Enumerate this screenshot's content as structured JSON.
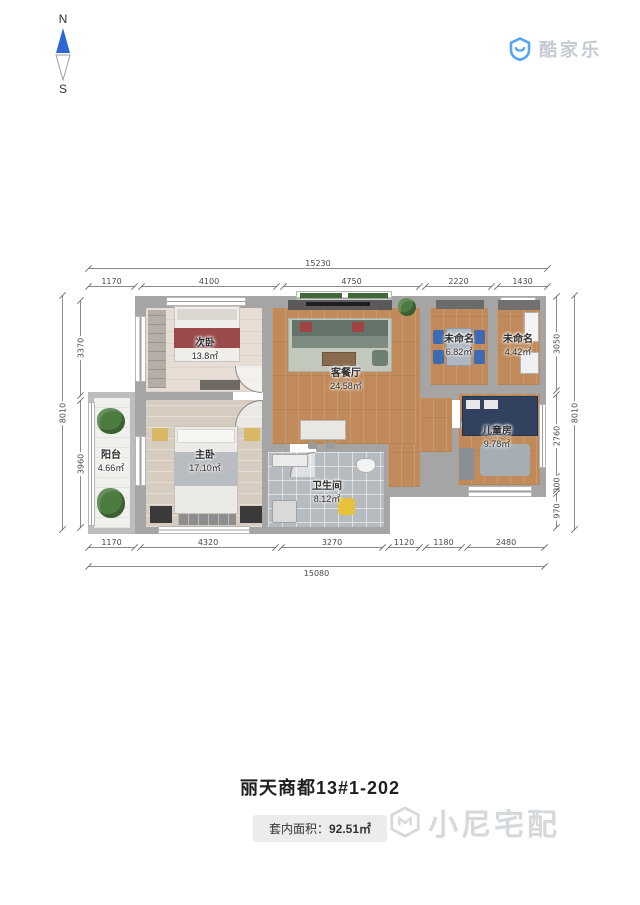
{
  "compass": {
    "north_label": "N",
    "south_label": "S"
  },
  "header": {
    "brand": "酷家乐"
  },
  "colors": {
    "brand_blue": "#57a4f5",
    "compass_blue": "#2e67d3",
    "wall_gray": "#a5a5a5",
    "wood_floor": "#c08a5a"
  },
  "floorplan": {
    "rooms": [
      {
        "name": "次卧",
        "area": "13.8㎡"
      },
      {
        "name": "客餐厅",
        "area": "24.58㎡"
      },
      {
        "name": "未命名",
        "area": "6.82㎡"
      },
      {
        "name": "未命名",
        "area": "4.42㎡"
      },
      {
        "name": "儿童房",
        "area": "9.78㎡"
      },
      {
        "name": "主卧",
        "area": "17.10㎡"
      },
      {
        "name": "卫生间",
        "area": "8.12㎡"
      },
      {
        "name": "阳台",
        "area": "4.66㎡"
      }
    ],
    "dimensions": {
      "top_total": "15230",
      "top_segments": [
        "1170",
        "4100",
        "4750",
        "2220",
        "1430"
      ],
      "bottom_segments": [
        "1170",
        "4320",
        "3270",
        "1120",
        "1180",
        "2480"
      ],
      "bottom_total": "15080",
      "left_outer": "8010",
      "left_inner": [
        "3370",
        "3960"
      ],
      "right_inner": [
        "3050",
        "2760",
        "300",
        "970"
      ],
      "right_outer": "8010"
    }
  },
  "footer": {
    "plan_title": "丽天商都13#1-202",
    "area_label": "套内面积：",
    "area_value": "92.51㎡",
    "watermark": "小尼宅配"
  }
}
